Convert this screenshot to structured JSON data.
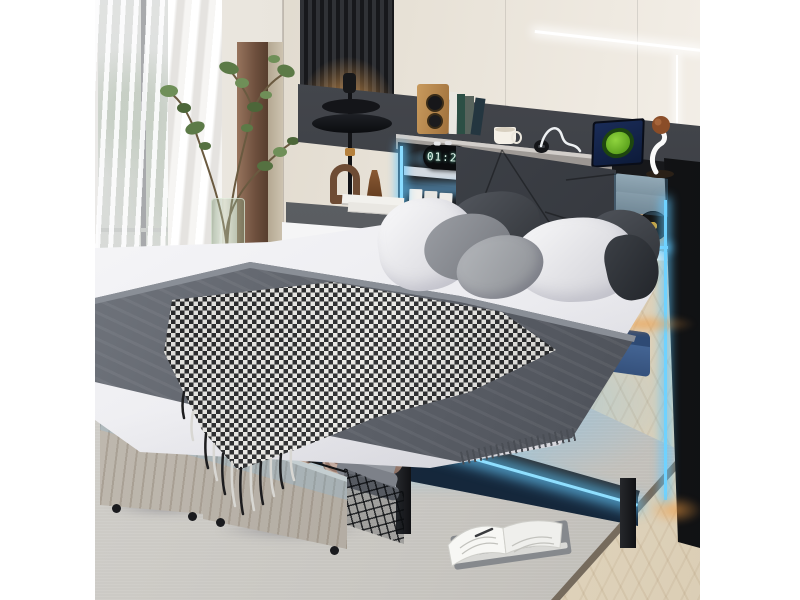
{
  "image": {
    "type": "product-photo",
    "subject": "Metal platform bed with LED-lit storage headboard, charging station and two under-bed rolling storage drawers",
    "background": "white studio margins left and right"
  },
  "clock": {
    "time": "01:29",
    "style": "black pill digital alarm clock, glowing digits"
  },
  "colors": {
    "led_accent_blue": "#7fd8ff",
    "led_warm_orange": "#e09a4e",
    "frame_black": "#17181b",
    "headboard_upholstery": "#42464c",
    "drawer_wood_gray": "#b7b1a8",
    "wall_beige": "#e2dbcd",
    "rug_gray": "#c9c7c1",
    "floor_wood": "#e6dbc4",
    "tablet_screen_navy": "#16264d",
    "tablet_logo_green": "#6fbe2e",
    "towel_mauve": "#b0938a",
    "blanket_gray": "#62666e",
    "curtain_white": "#f4f3f0",
    "plant_green": "#5c7a47",
    "speaker_wood": "#b9884c",
    "vinyl_label_gold": "#c9a23c"
  },
  "objects": [
    {
      "name": "window-curtains",
      "label": "Sheer white curtains over bright window"
    },
    {
      "name": "potted-plant",
      "label": "Tall leafy branch plant in green glass cylinder vase"
    },
    {
      "name": "slat-accent-panel",
      "label": "Dark wood slat wall panel with warm backlight"
    },
    {
      "name": "led-wall-lines",
      "label": "Thin white LED accent lines on beige wall"
    },
    {
      "name": "pendant-lamp",
      "label": "Black double-disc lamp with brass ring"
    },
    {
      "name": "nightstand",
      "label": "Gray-top nightstand with white drawer, books, vase and arch ornament"
    },
    {
      "name": "storage-headboard",
      "label": "Gray upholstered headboard with storage shelves and blue LED strips"
    },
    {
      "name": "wooden-speaker",
      "label": "Small wooden bookshelf speaker"
    },
    {
      "name": "book-row",
      "label": "Row of books on headboard shelf"
    },
    {
      "name": "digital-alarm-clock",
      "label": "Digital clock reading 01:29"
    },
    {
      "name": "coffee-mug",
      "label": "Cream mug on shelf"
    },
    {
      "name": "charging-outlet",
      "label": "Built-in charging outlet with white cable"
    },
    {
      "name": "tablet",
      "label": "Tablet with green logo on dark screen"
    },
    {
      "name": "basketball-figurine",
      "label": "White figurine holding brown basketball"
    },
    {
      "name": "storage-boxes",
      "label": "Two gray storage boxes in right cubby"
    },
    {
      "name": "vinyl-record",
      "label": "Black vinyl record with gold label"
    },
    {
      "name": "white-cup",
      "label": "Small white cup beside record"
    },
    {
      "name": "pillows",
      "label": "Two white pillows, two dark gray pillows, two gray accent pillows, dark bolster"
    },
    {
      "name": "gray-blanket",
      "label": "Dark gray blanket band across bed"
    },
    {
      "name": "houndstooth-throw",
      "label": "Black and white checked throw with fringe"
    },
    {
      "name": "led-underglow",
      "label": "Ice-blue LED glow under bed frame"
    },
    {
      "name": "storage-drawer-left",
      "label": "Rolling drawer with folded cream blankets in wire basket"
    },
    {
      "name": "storage-drawer-right",
      "label": "Rolling drawer with three rolled mauve towels and folded gray blankets"
    },
    {
      "name": "blue-storage-bag",
      "label": "Blue storage case under bed"
    },
    {
      "name": "area-rug",
      "label": "Large light gray area rug with dark edge"
    },
    {
      "name": "open-book",
      "label": "Open book on closed gray book lying on rug"
    },
    {
      "name": "wood-floor",
      "label": "Light herringbone wood floor"
    }
  ]
}
